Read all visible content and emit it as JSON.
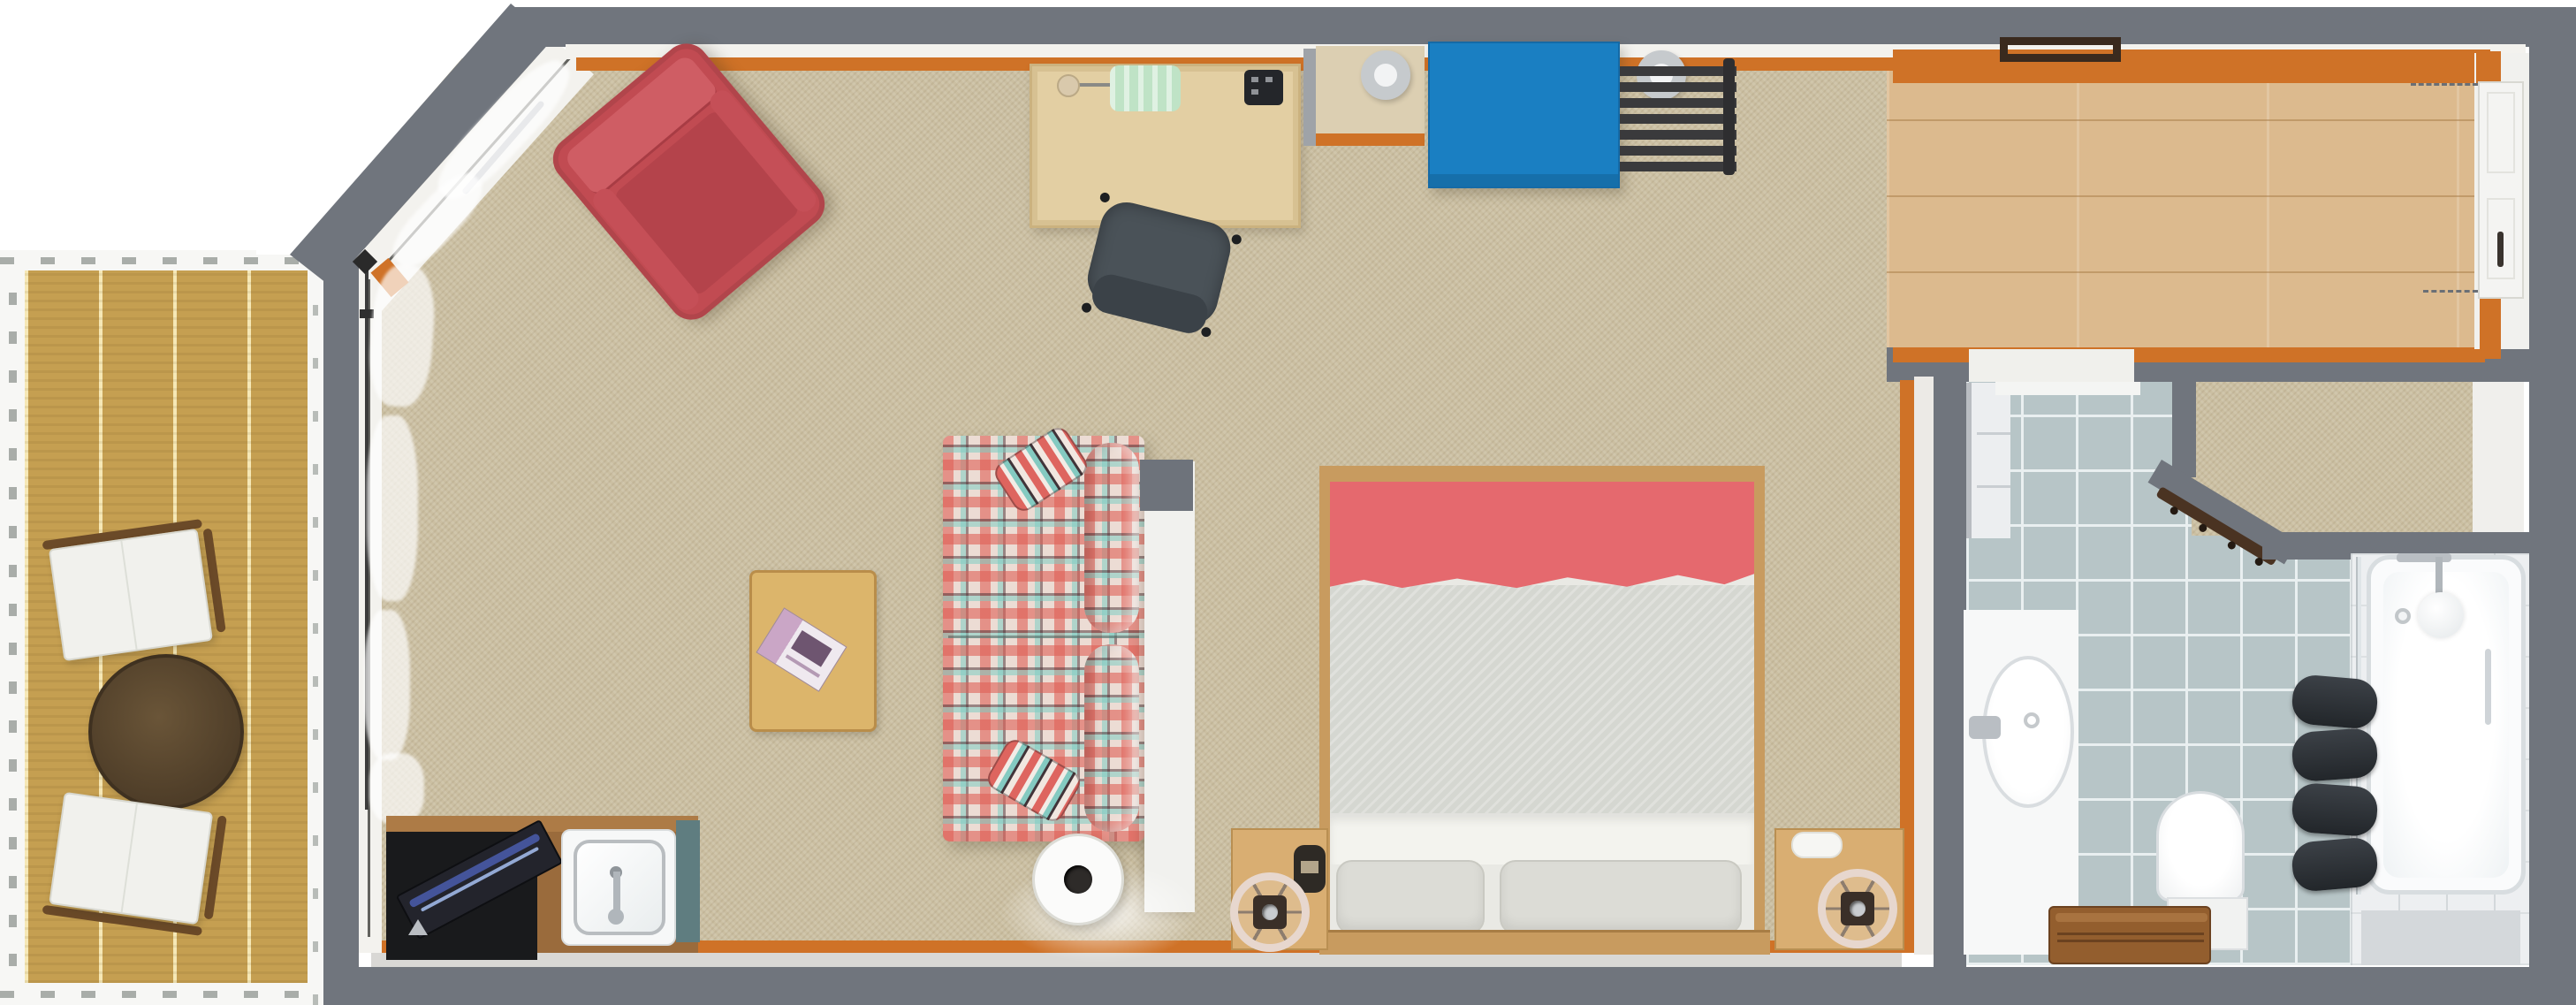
{
  "meta": {
    "type": "3d-floor-plan-render",
    "rooms": [
      "studio-living-bedroom",
      "balcony-deck",
      "entry-hall",
      "bathroom",
      "shower-tub-area",
      "wardrobe-nook"
    ]
  },
  "palette": {
    "wall_gray": "#70757d",
    "white_trim": "#f3f2ee",
    "orange_trim": "#cf7227",
    "carpet": "#cbbfa2",
    "deck_wood": "#c59f51",
    "hall_wood": "#dcba8e",
    "tile_blue": "#b7c5c7",
    "tub_room_white": "#edeff1",
    "desk_wood": "#e3cfa3",
    "counter_wood": "#9a6b3c",
    "bed_frame_wood": "#c89b5f",
    "nightstand_wood": "#d9ae72",
    "coffee_table_wood": "#dcb56b",
    "bench_wood": "#935e2e",
    "armchair_red": "#c14b52",
    "blanket_red": "#e5696e",
    "duvet_gray": "#d5d7d1",
    "pillow_gray": "#dcdcd6",
    "sofa_base": "#ecdcd4",
    "chest_blue": "#1a7fc2",
    "office_chair_gray": "#4a5258",
    "teal_band": "#5f7d80",
    "fixture_white": "#f7f8f8",
    "panel_tan": "#dccfb2",
    "lamp_green": "#bfe3c6",
    "partition_white": "#f1f1ee",
    "tub_white": "#fafbfc",
    "vanity_white": "#f7f8f8"
  },
  "counts": {
    "radiator_bars": 7,
    "deck_chairs": 2,
    "bed_pillows": 2,
    "sofa_throw_pillows": 2,
    "towel_rolls": 4,
    "coat_hooks": 4
  }
}
